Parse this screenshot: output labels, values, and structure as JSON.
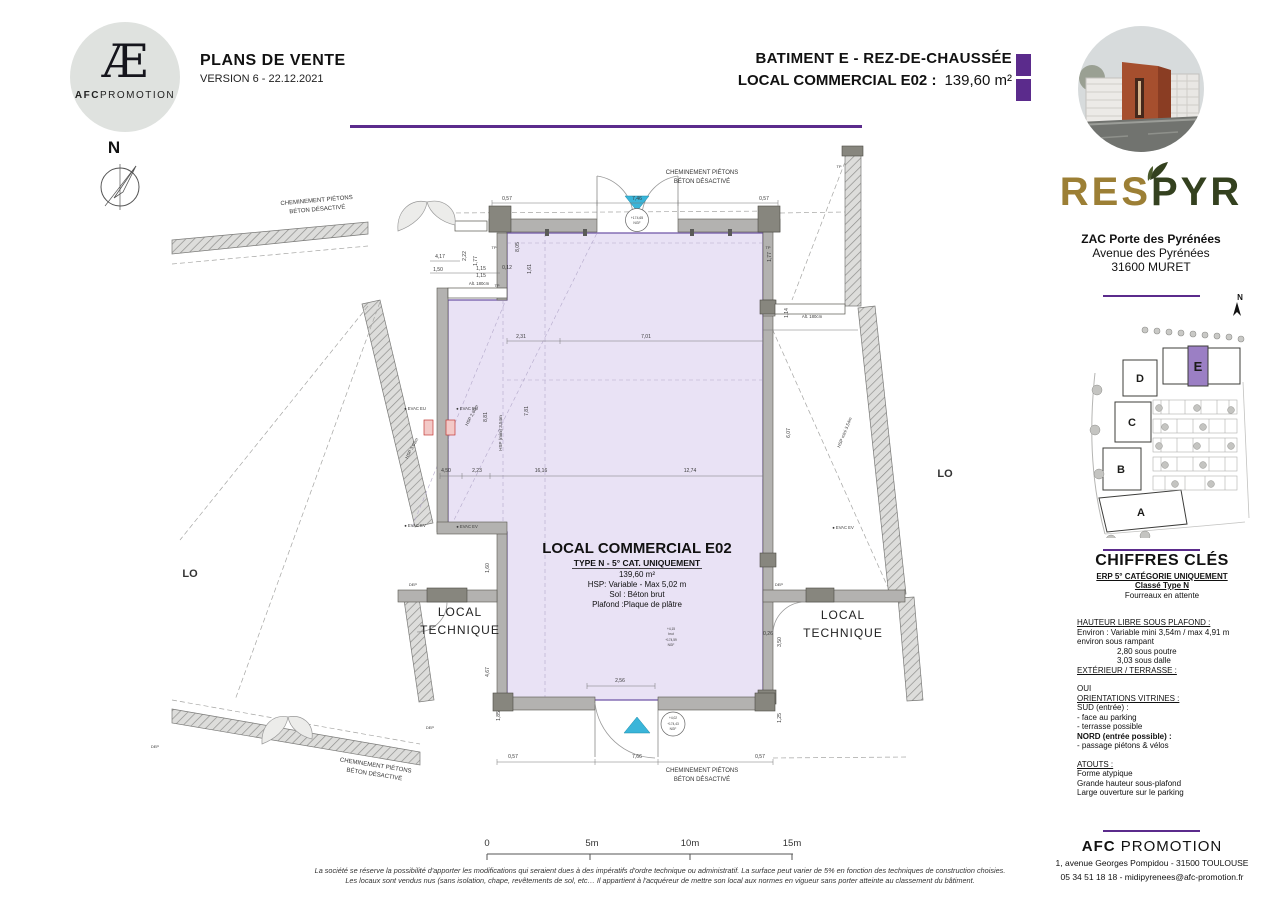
{
  "colors": {
    "accent_purple": "#5b2b8c",
    "room_fill": "#e9e2f5",
    "room_stroke": "#6f55a6",
    "cyan_marker": "#3ab5d9",
    "wall_gray": "#b3b2b0",
    "logo_gold": "#9c7f35",
    "logo_green": "#34411f"
  },
  "header": {
    "logo": {
      "monogram": "Æ",
      "brand_bold": "AFC",
      "brand_rest": "PROMOTION"
    },
    "title": "PLANS DE VENTE",
    "version": "VERSION 6 - 22.12.2021",
    "building_title": "BATIMENT E - REZ-DE-CHAUSSÉE",
    "local_title": "LOCAL COMMERCIAL E02 :",
    "local_area": "139,60  m²"
  },
  "compass": {
    "label": "N"
  },
  "sidebar": {
    "project_left": "RES",
    "project_right": "PYR",
    "address_line1": "ZAC Porte des Pyrénées",
    "address_line2": "Avenue des Pyrénées",
    "address_line3": "31600 MURET",
    "site_plan": {
      "north": "N",
      "letters": {
        "a": "A",
        "b": "B",
        "c": "C",
        "d": "D",
        "e": "E"
      },
      "highlighted": "E"
    },
    "chiffres": {
      "title": "CHIFFRES CLÉS",
      "erp1": "ERP 5° CATÉGORIE UNIQUEMENT",
      "erp2": "Classé Type N",
      "erp3": "Fourreaux en attente",
      "hauteur_title": "HAUTEUR LIBRE SOUS PLAFOND :",
      "hauteur1": "Environ :    Variable mini 3,54m / max 4,91 m",
      "hauteur2": "environ sous rampant",
      "hauteur3": "2,80 sous poutre",
      "hauteur4": "3,03 sous dalle",
      "exterieur_title": "EXTÉRIEUR / TERRASSE :",
      "exterieur_value": "OUI",
      "orientations_title": "ORIENTATIONS VITRINES :",
      "o1": "SUD (entrée) :",
      "o2": "- face au parking",
      "o3": "- terrasse possible",
      "o4": "NORD (entrée possible) :",
      "o5": "- passage piétons & vélos",
      "atouts_title": "ATOUTS :",
      "a1": "Forme atypique",
      "a2": "Grande hauteur sous-plafond",
      "a3": "Large ouverture sur le parking"
    },
    "footer": {
      "company_bold": "AFC",
      "company_rest": " PROMOTION",
      "address": "1, avenue Georges Pompidou - 31500 TOULOUSE",
      "contact": "05 34 51 18 18 - midipyrenees@afc-promotion.fr"
    }
  },
  "plan": {
    "info": {
      "title": "LOCAL COMMERCIAL E02",
      "subtitle": "TYPE N - 5° CAT. UNIQUEMENT",
      "area": "139,60 m²",
      "hsp": "HSP: Variable - Max 5,02 m",
      "sol": "Sol : Béton brut",
      "plafond": "Plafond :Plaque de plâtre"
    },
    "local_technique": {
      "line1": "LOCAL",
      "line2": "TECHNIQUE"
    },
    "cheminement": {
      "line1": "CHEMINEMENT PIÉTONS",
      "line2": "BÉTON DÉSACTIVÉ"
    },
    "partial_left": "LO",
    "partial_right": "LO",
    "dim_labels": [
      {
        "t": "0,57",
        "x": 507,
        "y": 200
      },
      {
        "t": "7,46",
        "x": 637,
        "y": 200
      },
      {
        "t": "0,57",
        "x": 764,
        "y": 200
      },
      {
        "t": "4,17",
        "x": 440,
        "y": 258
      },
      {
        "t": "1,50",
        "x": 438,
        "y": 271
      },
      {
        "t": "2,22",
        "x": 466,
        "y": 256,
        "r": -90
      },
      {
        "t": "1,77",
        "x": 477,
        "y": 261,
        "r": -90
      },
      {
        "t": "1,15",
        "x": 481,
        "y": 270
      },
      {
        "t": "1,15",
        "x": 481,
        "y": 277
      },
      {
        "t": "0,12",
        "x": 507,
        "y": 269
      },
      {
        "t": "Alt. 180cm",
        "x": 479,
        "y": 285,
        "s": 4.3
      },
      {
        "t": "Alt. 180cm",
        "x": 812,
        "y": 318,
        "s": 4.3
      },
      {
        "t": "TP",
        "x": 494,
        "y": 249,
        "s": 4
      },
      {
        "t": "TP",
        "x": 768,
        "y": 249,
        "s": 4
      },
      {
        "t": "TP",
        "x": 839,
        "y": 168,
        "s": 4
      },
      {
        "t": "TP",
        "x": 497,
        "y": 287,
        "s": 4
      },
      {
        "t": "2,31",
        "x": 521,
        "y": 338
      },
      {
        "t": "7,01",
        "x": 646,
        "y": 338
      },
      {
        "t": "8,05",
        "x": 519,
        "y": 247,
        "r": -90
      },
      {
        "t": "1,61",
        "x": 531,
        "y": 269,
        "r": -90
      },
      {
        "t": "1,77",
        "x": 771,
        "y": 257,
        "r": -90
      },
      {
        "t": "1,14",
        "x": 788,
        "y": 313,
        "r": -90
      },
      {
        "t": "6,07",
        "x": 790,
        "y": 433,
        "r": -90
      },
      {
        "t": "8,81",
        "x": 487,
        "y": 417,
        "r": -90
      },
      {
        "t": "7,81",
        "x": 528,
        "y": 411,
        "r": -90
      },
      {
        "t": "4,50",
        "x": 446,
        "y": 472
      },
      {
        "t": "2,23",
        "x": 477,
        "y": 472
      },
      {
        "t": "16,16",
        "x": 541,
        "y": 472
      },
      {
        "t": "12,74",
        "x": 690,
        "y": 472
      },
      {
        "t": "1,60",
        "x": 489,
        "y": 568,
        "r": -90
      },
      {
        "t": "4,67",
        "x": 489,
        "y": 672,
        "r": -90
      },
      {
        "t": "1,85",
        "x": 500,
        "y": 716,
        "r": -90
      },
      {
        "t": "0,26",
        "x": 768,
        "y": 635
      },
      {
        "t": "3,50",
        "x": 781,
        "y": 642,
        "r": -90
      },
      {
        "t": "1,25",
        "x": 781,
        "y": 718,
        "r": -90
      },
      {
        "t": "2,56",
        "x": 620,
        "y": 682
      },
      {
        "t": "0,57",
        "x": 513,
        "y": 758
      },
      {
        "t": "7,66",
        "x": 637,
        "y": 758
      },
      {
        "t": "0,57",
        "x": 760,
        "y": 758
      },
      {
        "t": "DEP",
        "x": 413,
        "y": 586,
        "s": 4
      },
      {
        "t": "DEP",
        "x": 779,
        "y": 586,
        "s": 4
      },
      {
        "t": "DEP",
        "x": 430,
        "y": 729,
        "s": 4
      },
      {
        "t": "DEP",
        "x": 155,
        "y": 748,
        "s": 4
      },
      {
        "t": "● EVAC EU",
        "x": 415,
        "y": 410,
        "s": 4.2
      },
      {
        "t": "● EVAC EU",
        "x": 467,
        "y": 410,
        "s": 4.2
      },
      {
        "t": "● EVAC EV",
        "x": 415,
        "y": 527,
        "s": 4.2
      },
      {
        "t": "● EVAC EV",
        "x": 467,
        "y": 528,
        "s": 4.2
      },
      {
        "t": "● EVAC EV",
        "x": 843,
        "y": 529,
        "s": 4.2
      },
      {
        "t": "HSP 3,03m",
        "x": 413,
        "y": 449,
        "r": -62,
        "s": 4.5
      },
      {
        "t": "HSP 2,80m",
        "x": 473,
        "y": 416,
        "r": -62,
        "s": 4.5
      },
      {
        "t": "HSP (mini) 3,54m",
        "x": 502,
        "y": 433,
        "r": -90,
        "s": 4.5
      },
      {
        "t": "HSP mini 3,54m",
        "x": 846,
        "y": 433,
        "r": -68,
        "s": 4.5
      },
      {
        "t": "+174,65",
        "x": 637,
        "y": 219,
        "s": 3.4
      },
      {
        "t": "NGF",
        "x": 637,
        "y": 224,
        "s": 3.4
      },
      {
        "t": "+4,15",
        "x": 671,
        "y": 630,
        "s": 3.2
      },
      {
        "t": "brut",
        "x": 671,
        "y": 635,
        "s": 3.2
      },
      {
        "t": "+174,59",
        "x": 671,
        "y": 641,
        "s": 3.2
      },
      {
        "t": "NGF",
        "x": 671,
        "y": 646,
        "s": 3.2
      },
      {
        "t": "+4,02",
        "x": 673,
        "y": 719,
        "s": 3.2
      },
      {
        "t": "+174,43",
        "x": 673,
        "y": 725,
        "s": 3.2
      },
      {
        "t": "NGF",
        "x": 673,
        "y": 730,
        "s": 3.2
      }
    ]
  },
  "scalebar": {
    "labels": [
      "0",
      "5m",
      "10m",
      "15m"
    ]
  },
  "disclaimer": {
    "line1": "La société se réserve la possibilité d'apporter les modifications qui seraient dues à des impératifs d'ordre technique ou administratif. La surface peut varier de 5% en fonction des techniques de construction choisies.",
    "line2": "Les locaux sont vendus nus (sans isolation, chape, revêtements de sol, etc… Il appartient à l'acquéreur de mettre son local aux normes en vigueur sans porter atteinte au classement du bâtiment."
  }
}
